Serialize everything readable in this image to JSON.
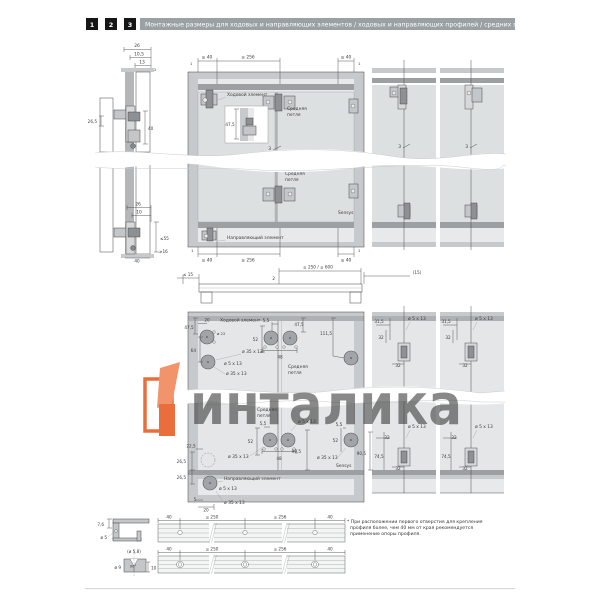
{
  "header": {
    "badges": [
      "1",
      "2",
      "3"
    ],
    "title": "Монтажные размеры для ходовых и направляющих элементов / ходовых и направляющих профилей / средних петель"
  },
  "colors": {
    "accent_orange": "#E8622C",
    "accent_orange_light": "#F08A5F",
    "header_bar": "#9AA0A3",
    "badge_bg": "#161616"
  },
  "section_left_top": {
    "d26": "26",
    "d105": "10,5",
    "d13": "13",
    "d2": "2",
    "d265": "26,5",
    "d40": "40"
  },
  "section_left_bottom": {
    "d26": "26",
    "d10": "10",
    "d55": "≤55",
    "d16": "≥16",
    "d40": "40"
  },
  "front_view": {
    "one_tl": "1",
    "one_tr": "1",
    "one_bl": "1",
    "one_br": "1",
    "top_40l": "≤ 40",
    "top_256": "≤ 256",
    "top_40r": "≤ 40",
    "bot_40l": "≤ 40",
    "bot_256": "≤ 256",
    "bot_40r": "≤ 40",
    "inset_475": "47,5",
    "gap3": "3",
    "running_element": "Ходовой элемент",
    "hinge1_l1": "Средняя",
    "hinge1_l2": "петля",
    "hinge2_l1": "Средняя",
    "hinge2_l2": "петля",
    "sensys": "Sensys",
    "guide_element": "Направляющий элемент"
  },
  "right_panels": {
    "gap3_a": "3",
    "gap3_b": "3"
  },
  "plan_view": {
    "d15l": "≤ 15",
    "d2": "2",
    "span": "≥ 250 / ≤ 600",
    "d15r": "(15)"
  },
  "drill_view": {
    "v475l": "47,5",
    "h20": "20",
    "running_element": "Ходовой элемент",
    "d22": "ø 22",
    "v64": "64",
    "hole35a": "ø 35 x 13",
    "hole5a": "ø 5 x 13",
    "hole35b": "ø 35 x 13",
    "d55t": "5,5",
    "v52t": "52",
    "w48t": "48",
    "v475r": "47,5",
    "v1115": "111,5",
    "hinge1_l1": "Средняя",
    "hinge1_l2": "петля",
    "hinge2_l1": "Средняя",
    "hinge2_l2": "петля",
    "hole5b": "ø 5 x 13",
    "d55b": "5,5",
    "v52b": "52",
    "hole35c": "ø 35 x 13",
    "w48b": "48",
    "v905": "90,5",
    "d55r": "5,5",
    "v52r": "52",
    "hole35r": "ø 35 x 13",
    "sensys": "Sensys",
    "v225": "22,5",
    "v265a": "26,5",
    "v265b": "26,5",
    "guide_element": "Направляющий элемент",
    "hole5c": "ø 5 x 13",
    "d5": "5",
    "hole35d": "ø 35 x 13",
    "h20b": "20"
  },
  "right_columns": {
    "v905": "90,5",
    "top": {
      "d315": "31,5",
      "d32a": "32",
      "hole5": "ø 5 x 13",
      "d32b": "32"
    },
    "bottom": {
      "hole5": "ø 5 x 13",
      "d32a": "32",
      "d745": "74,5",
      "d32b": "32"
    }
  },
  "profiles": {
    "cs_top": {
      "d76": "7,6",
      "hole": "ø 5"
    },
    "cs_bottom": {
      "hole": "(ø 5,8)",
      "d9": "ø 9",
      "angle": "90°",
      "d10": "10"
    },
    "rail_top_dims": [
      "40",
      "≤ 250",
      "≤ 256",
      "40"
    ],
    "rail_bottom_dims": [
      "40",
      "≤ 250",
      "≤ 256",
      "40"
    ],
    "note": [
      "* При расположении первого отверстия для крепления",
      "профиля более, чем 40 мм от края рекомендуется",
      "применение опоры профиля."
    ]
  },
  "watermark": {
    "text": "инталика",
    "logo_color": "#E8622C",
    "logo_color_light": "#F08A5F",
    "text_color": "#63666A"
  }
}
